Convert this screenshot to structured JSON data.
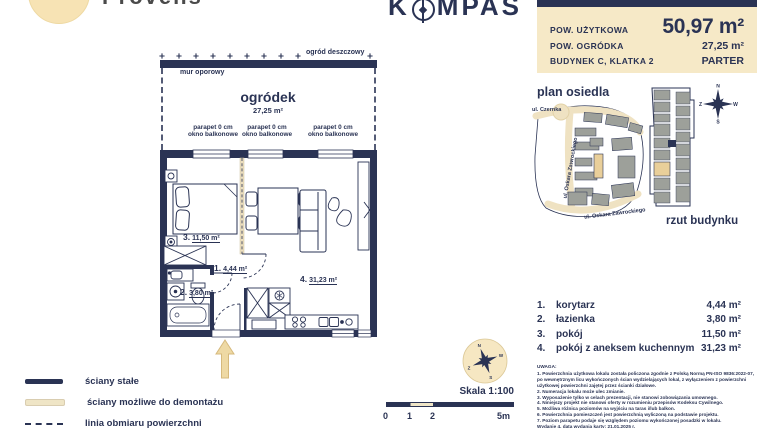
{
  "brand": {
    "left_name": "Provens",
    "right_prefix": "K",
    "right_suffix": "MPAS"
  },
  "summary": {
    "rows": [
      {
        "label": "POW. UŻYTKOWA",
        "value": "50,97 m²"
      },
      {
        "label": "POW. OGRÓDKA",
        "value": "27,25 m²"
      },
      {
        "label": "BUDYNEK C, KLATKA 2",
        "value": "PARTER"
      }
    ]
  },
  "plan": {
    "garden": {
      "name": "ogródek",
      "area": "27,25 m²"
    },
    "rain_garden_label": "ogród deszczowy",
    "retaining_wall_label": "mur oporowy",
    "window_label_line1": "parapet 0 cm",
    "window_label_line2": "okno balkonowe",
    "room_labels": [
      {
        "num": "3.",
        "area": "11,50 m²"
      },
      {
        "num": "1.",
        "area": "4,44 m²"
      },
      {
        "num": "2.",
        "area": "3,80 m²"
      },
      {
        "num": "4.",
        "area": "31,23 m²"
      }
    ]
  },
  "site": {
    "plan_title": "plan osiedla",
    "building_view_title": "rzut budynku",
    "street_top": "ul. Czernka",
    "street_left": "ul. Oskara Zawrockiego",
    "street_bottom": "ul. Oskara Zawrockiego"
  },
  "compass": {
    "n": "N",
    "e": "W",
    "s": "S",
    "w": "Z"
  },
  "rooms": {
    "items": [
      {
        "no": "1.",
        "name": "korytarz",
        "area": "4,44 m²"
      },
      {
        "no": "2.",
        "name": "łazienka",
        "area": "3,80 m²"
      },
      {
        "no": "3.",
        "name": "pokój",
        "area": "11,50 m²"
      },
      {
        "no": "4.",
        "name": "pokój z aneksem kuchennym",
        "area": "31,23 m²"
      }
    ]
  },
  "notes": {
    "title": "UWAGA:",
    "lines": [
      "1. Powierzchnia użytkowa lokalu została policzona zgodnie z Polską Normą PN-ISO 9836:2022-07, po wewnętrznym licu wykończonych ścian wydzielających lokal, z wyłączeniem z powierzchni użytkowej powierzchni zajętej przez ścianki działowe.",
      "2. Numeracja lokalu może ulec zmianie.",
      "3. Wyposażenie tylko w celach prezentacji, nie stanowi zobowiązania umownego.",
      "4. Niniejszy projekt nie stanowi oferty w rozumieniu przepisów Kodeksu Cywilnego.",
      "5. Możliwa różnica poziomów na wyjściu na taras i/lub balkon.",
      "6. Powierzchnia pomieszczeń jest powierzchnią wyliczoną na podstawie projektu.",
      "7. Poziom parapetu podaje się względem poziomu wykończonej posadzki w lokalu.",
      "Wydanie 4, data wydania karty: 21.01.2025 r."
    ]
  },
  "legend": {
    "items": [
      {
        "label": "ściany stałe"
      },
      {
        "label": "ściany możliwe do demontażu"
      },
      {
        "label": "linia obmiaru powierzchni"
      }
    ],
    "scale_label": "Skala 1:100",
    "ticks": [
      "0",
      "1",
      "2",
      "5m"
    ]
  },
  "colors": {
    "navy": "#2a3354",
    "cream": "#f6e9c7",
    "gold": "#e9cf9a",
    "gray": "#9da09a"
  }
}
